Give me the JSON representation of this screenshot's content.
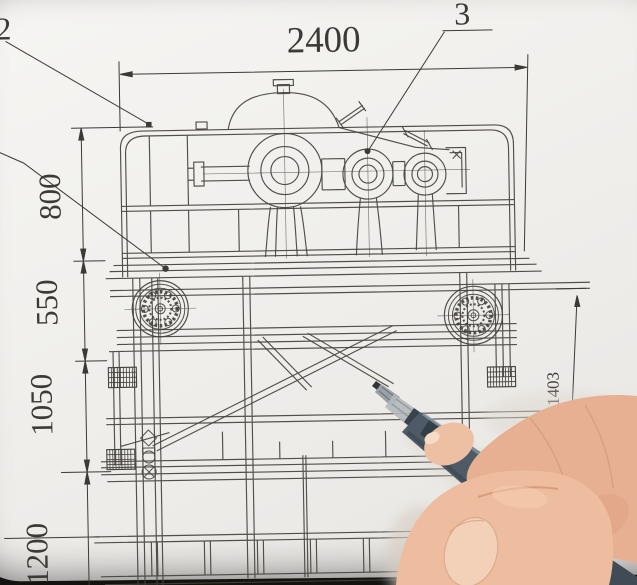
{
  "labels": {
    "part_2": "2",
    "part_3": "3"
  },
  "dimensions": {
    "top_width": "2400",
    "left": [
      "800",
      "550",
      "1050",
      "1200"
    ],
    "right_height": "1403"
  },
  "colors": {
    "paper": "#f2f1ee",
    "ink": "#3d3935",
    "background": "#14130f",
    "pen_barrel": "#4e5b67",
    "pen_grip": "#b3b8bb",
    "pen_tip": "#9aa0a5",
    "skin": "#e9b597",
    "skin_shadow": "#d49a7c",
    "nail": "#f2d1b8"
  }
}
